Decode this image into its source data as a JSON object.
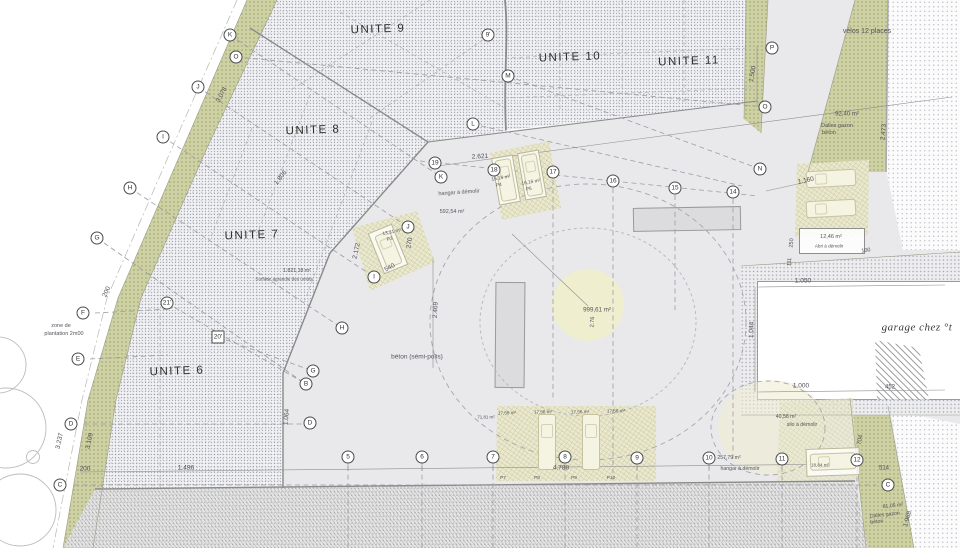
{
  "colors": {
    "olive_band": "#cdd1a3",
    "parking_fill": "#eae8cd",
    "courtyard": "#e9e9eb",
    "stipple_area": "#f2f2f4",
    "center_circle": "#efeecf",
    "linework": "#8a8a8a"
  },
  "units": [
    {
      "label": "UNITE 9",
      "x": 378,
      "y": 30
    },
    {
      "label": "UNITE 10",
      "x": 570,
      "y": 58
    },
    {
      "label": "UNITE 11",
      "x": 689,
      "y": 62
    },
    {
      "label": "UNITE 8",
      "x": 313,
      "y": 131
    },
    {
      "label": "UNITE 7",
      "x": 252,
      "y": 236
    },
    {
      "label": "UNITE 6",
      "x": 177,
      "y": 372
    }
  ],
  "dimensions": [
    {
      "t": "2.621",
      "x": 480,
      "y": 157,
      "r": -3
    },
    {
      "t": "1.806",
      "x": 281,
      "y": 178,
      "r": -52
    },
    {
      "t": "3.078",
      "x": 222,
      "y": 95,
      "r": -62
    },
    {
      "t": "200",
      "x": 107,
      "y": 292,
      "r": -65
    },
    {
      "t": "3.109",
      "x": 90,
      "y": 441,
      "r": -78
    },
    {
      "t": "3.237",
      "x": 60,
      "y": 441,
      "r": -78
    },
    {
      "t": "200",
      "x": 85,
      "y": 469
    },
    {
      "t": "1.496",
      "x": 186,
      "y": 468
    },
    {
      "t": "1.064",
      "x": 287,
      "y": 417,
      "r": -85
    },
    {
      "t": "2.469",
      "x": 436,
      "y": 310,
      "r": -87
    },
    {
      "t": "2.172",
      "x": 357,
      "y": 251,
      "r": -78
    },
    {
      "t": "270",
      "x": 410,
      "y": 243,
      "r": -80
    },
    {
      "t": "540",
      "x": 390,
      "y": 268,
      "r": -30
    },
    {
      "t": "2.76",
      "x": 593,
      "y": 322,
      "r": -87,
      "s": 5.5
    },
    {
      "t": "1.500",
      "x": 753,
      "y": 74,
      "r": -80
    },
    {
      "t": "2.473",
      "x": 884,
      "y": 132,
      "r": -85
    },
    {
      "t": "1.160",
      "x": 806,
      "y": 181,
      "r": -12
    },
    {
      "t": "250",
      "x": 792,
      "y": 243,
      "r": -85,
      "s": 5.5
    },
    {
      "t": "111",
      "x": 790,
      "y": 262,
      "r": -85,
      "s": 5.5
    },
    {
      "t": "100",
      "x": 866,
      "y": 251,
      "r": -8,
      "s": 5.5
    },
    {
      "t": "1.050",
      "x": 803,
      "y": 281
    },
    {
      "t": "1.044",
      "x": 752,
      "y": 330,
      "r": -88
    },
    {
      "t": "1.000",
      "x": 801,
      "y": 386
    },
    {
      "t": "452",
      "x": 890,
      "y": 388,
      "s": 6
    },
    {
      "t": "514",
      "x": 884,
      "y": 469,
      "s": 6
    },
    {
      "t": "704",
      "x": 861,
      "y": 440,
      "r": -80,
      "s": 6
    },
    {
      "t": "1.968",
      "x": 908,
      "y": 519,
      "r": -74
    },
    {
      "t": "4.788",
      "x": 561,
      "y": 468
    }
  ],
  "annotations": [
    {
      "t": "vélos 12 places",
      "x": 867,
      "y": 32,
      "s": 7
    },
    {
      "t": "92,40 m²",
      "x": 847,
      "y": 115,
      "s": 6
    },
    {
      "t": "Dalles gazon",
      "x": 837,
      "y": 126,
      "s": 5.5
    },
    {
      "t": "béton",
      "x": 829,
      "y": 133,
      "s": 5.5
    },
    {
      "t": "hangar à démolir",
      "x": 459,
      "y": 193,
      "s": 5.5,
      "r": -4
    },
    {
      "t": "592,54 m²",
      "x": 452,
      "y": 212,
      "s": 5.5
    },
    {
      "t": "16,16 m²",
      "x": 501,
      "y": 179,
      "s": 4.8,
      "r": -10
    },
    {
      "t": "P4",
      "x": 499,
      "y": 186,
      "s": 4.8,
      "r": -10
    },
    {
      "t": "16,16 m²",
      "x": 531,
      "y": 183,
      "s": 4.8,
      "r": -10
    },
    {
      "t": "P5",
      "x": 529,
      "y": 190,
      "s": 4.8,
      "r": -10
    },
    {
      "t": "13,31 m²",
      "x": 392,
      "y": 233,
      "s": 4.8,
      "r": -12
    },
    {
      "t": "P3",
      "x": 390,
      "y": 240,
      "s": 4.8,
      "r": -12
    },
    {
      "t": "1.821,18 m²",
      "x": 297,
      "y": 272,
      "s": 5.2
    },
    {
      "t": "Surface agrandie des unités",
      "x": 284,
      "y": 279,
      "s": 4.6
    },
    {
      "t": "zone de",
      "x": 61,
      "y": 326,
      "s": 5.5
    },
    {
      "t": "plantation 2m00",
      "x": 64,
      "y": 334,
      "s": 5.5
    },
    {
      "t": "béton (sémi-polis)",
      "x": 417,
      "y": 357,
      "s": 6.5
    },
    {
      "t": "999,61 m²",
      "x": 597,
      "y": 310,
      "s": 6.2
    },
    {
      "t": "garage chez °t",
      "x": 917,
      "y": 328,
      "s": 11,
      "cls": "script"
    },
    {
      "t": "12,46 m²",
      "x": 831,
      "y": 237,
      "s": 5.5
    },
    {
      "t": "Abri à démolir",
      "x": 829,
      "y": 246,
      "s": 4.6
    },
    {
      "t": "40,58 m²",
      "x": 786,
      "y": 418,
      "s": 5.2
    },
    {
      "t": "silo à démolir",
      "x": 802,
      "y": 426,
      "s": 5.2
    },
    {
      "t": "257,79 m²",
      "x": 729,
      "y": 459,
      "s": 5.2
    },
    {
      "t": "hangar à démolir",
      "x": 740,
      "y": 470,
      "s": 5.2
    },
    {
      "t": "18,84 m²",
      "x": 820,
      "y": 465,
      "s": 4.6
    },
    {
      "t": "17,56 m²",
      "x": 507,
      "y": 413,
      "s": 4.6,
      "r": -2
    },
    {
      "t": "17,56 m²",
      "x": 543,
      "y": 412,
      "s": 4.6,
      "r": -2
    },
    {
      "t": "17,56 m²",
      "x": 580,
      "y": 412,
      "s": 4.6,
      "r": -2
    },
    {
      "t": "17,56 m²",
      "x": 616,
      "y": 411,
      "s": 4.6,
      "r": -2
    },
    {
      "t": "71,81 m²",
      "x": 486,
      "y": 417,
      "s": 4.4
    },
    {
      "t": "P7",
      "x": 503,
      "y": 479,
      "s": 4.8
    },
    {
      "t": "P8",
      "x": 537,
      "y": 479,
      "s": 4.8
    },
    {
      "t": "P9",
      "x": 574,
      "y": 479,
      "s": 4.8
    },
    {
      "t": "P10",
      "x": 611,
      "y": 479,
      "s": 4.8
    },
    {
      "t": "81,05 m²",
      "x": 893,
      "y": 507,
      "s": 5.2,
      "r": -6
    },
    {
      "t": "Dalles gazon",
      "x": 885,
      "y": 516,
      "s": 5.2,
      "r": -6
    },
    {
      "t": "béton",
      "x": 877,
      "y": 523,
      "s": 5.2,
      "r": -6
    }
  ],
  "markers": [
    {
      "l": "K",
      "x": 230,
      "y": 35
    },
    {
      "l": "O",
      "x": 236,
      "y": 57
    },
    {
      "l": "J",
      "x": 198,
      "y": 87
    },
    {
      "l": "I",
      "x": 163,
      "y": 137
    },
    {
      "l": "H",
      "x": 130,
      "y": 188
    },
    {
      "l": "G",
      "x": 97,
      "y": 238
    },
    {
      "l": "F",
      "x": 83,
      "y": 313
    },
    {
      "l": "E",
      "x": 78,
      "y": 359
    },
    {
      "l": "D",
      "x": 71,
      "y": 424
    },
    {
      "l": "C",
      "x": 60,
      "y": 485
    },
    {
      "l": "21'",
      "x": 167,
      "y": 303
    },
    {
      "l": "20'",
      "x": 218,
      "y": 337,
      "sq": true
    },
    {
      "l": "9'",
      "x": 488,
      "y": 35
    },
    {
      "l": "M",
      "x": 508,
      "y": 76
    },
    {
      "l": "L",
      "x": 473,
      "y": 124
    },
    {
      "l": "19",
      "x": 435,
      "y": 163
    },
    {
      "l": "K",
      "x": 441,
      "y": 177
    },
    {
      "l": "18",
      "x": 494,
      "y": 170
    },
    {
      "l": "17",
      "x": 553,
      "y": 172
    },
    {
      "l": "16",
      "x": 613,
      "y": 181
    },
    {
      "l": "15",
      "x": 675,
      "y": 188
    },
    {
      "l": "14",
      "x": 733,
      "y": 192
    },
    {
      "l": "P",
      "x": 772,
      "y": 48
    },
    {
      "l": "O",
      "x": 765,
      "y": 107
    },
    {
      "l": "N",
      "x": 760,
      "y": 169
    },
    {
      "l": "J",
      "x": 408,
      "y": 227
    },
    {
      "l": "I",
      "x": 374,
      "y": 277
    },
    {
      "l": "H",
      "x": 342,
      "y": 328
    },
    {
      "l": "G",
      "x": 313,
      "y": 371
    },
    {
      "l": "B",
      "x": 306,
      "y": 384
    },
    {
      "l": "D",
      "x": 310,
      "y": 423
    },
    {
      "l": "5",
      "x": 348,
      "y": 457
    },
    {
      "l": "6",
      "x": 422,
      "y": 457
    },
    {
      "l": "7",
      "x": 493,
      "y": 457
    },
    {
      "l": "8",
      "x": 565,
      "y": 457
    },
    {
      "l": "9",
      "x": 637,
      "y": 458
    },
    {
      "l": "10",
      "x": 709,
      "y": 458
    },
    {
      "l": "11",
      "x": 782,
      "y": 459
    },
    {
      "l": "12",
      "x": 857,
      "y": 460
    },
    {
      "l": "C",
      "x": 888,
      "y": 485
    }
  ]
}
